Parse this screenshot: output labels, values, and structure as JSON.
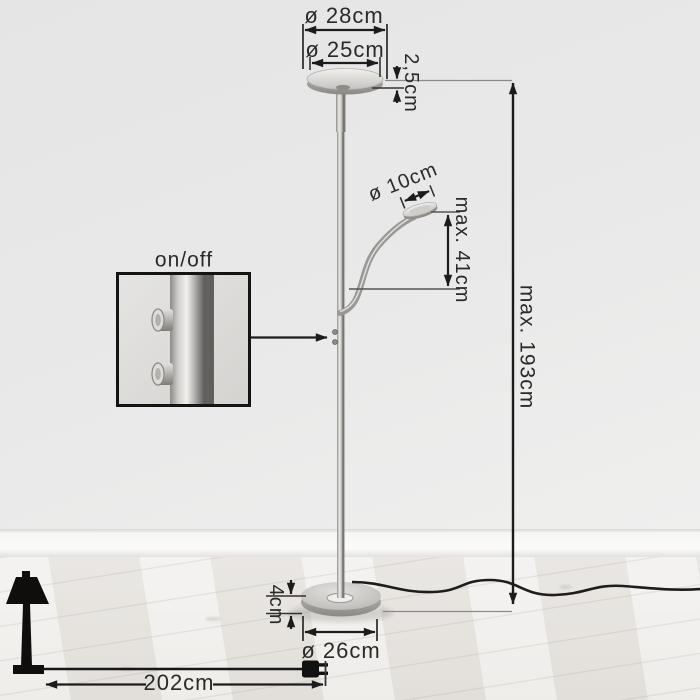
{
  "dimensions": {
    "head_outer_diameter": "ø 28cm",
    "head_inner_diameter": "ø 25cm",
    "head_thickness": "2,5cm",
    "reading_head_diameter": "ø 10cm",
    "reading_head_max_height": "max. 41cm",
    "lamp_max_height": "max. 193cm",
    "base_height": "4cm",
    "base_diameter": "ø 26cm",
    "cord_length": "202cm"
  },
  "inset": {
    "switch_label": "on/off"
  },
  "colors": {
    "annotation": "#1c1c1c",
    "wall": "#e8e8e7",
    "floor": "#edeae6",
    "metal": "#b9b7b4"
  }
}
